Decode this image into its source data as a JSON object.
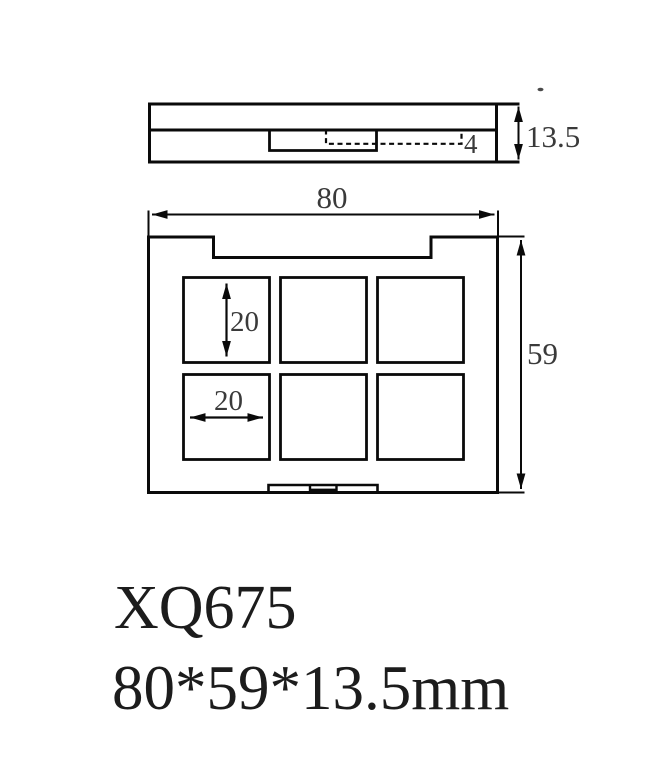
{
  "drawing": {
    "side_view": {
      "depth_label": "13.5",
      "slot_depth_label": "4"
    },
    "top_view": {
      "width_label": "80",
      "height_label": "59",
      "pan_height_label": "20",
      "pan_width_label": "20",
      "pan_rows": 2,
      "pan_cols": 3
    },
    "caption": {
      "model": "XQ675",
      "size": "80*59*13.5mm"
    },
    "colors": {
      "line": "#0a0a0a",
      "dimension_text": "#3a3a3a",
      "caption_text": "#1c1c1c",
      "background": "#ffffff"
    }
  }
}
